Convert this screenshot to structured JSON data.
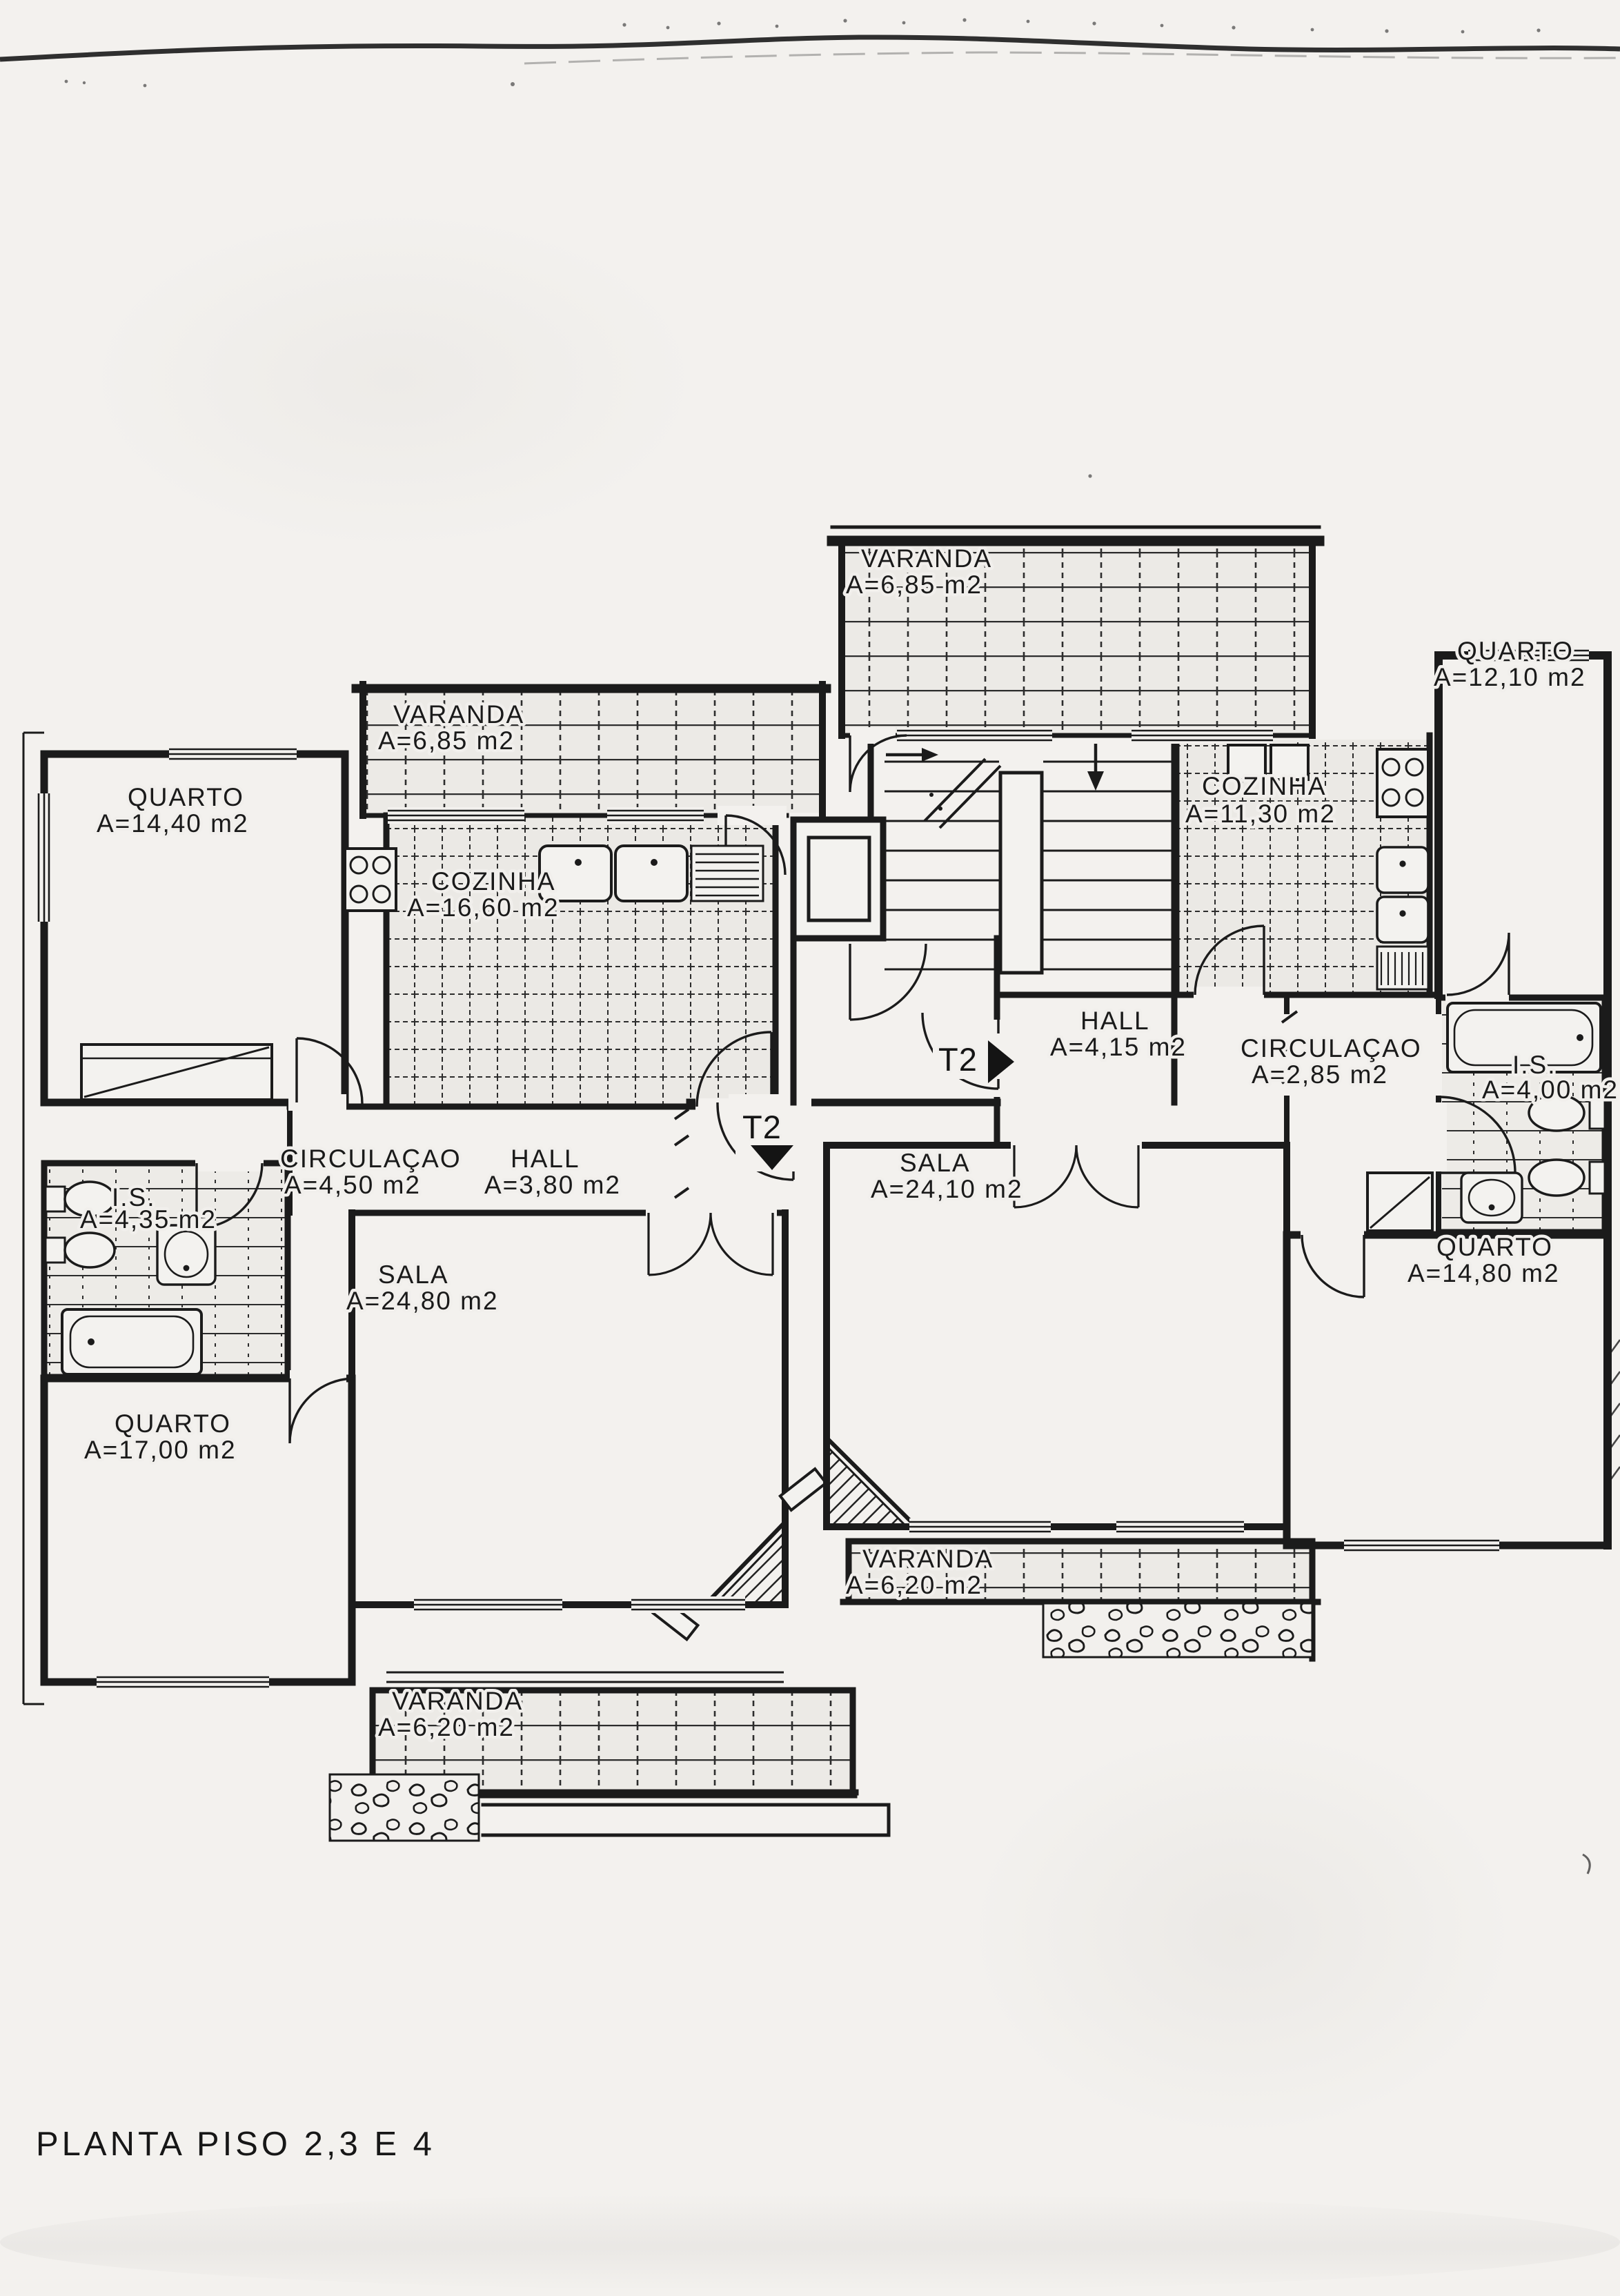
{
  "title": "PLANTA PISO 2,3 E 4",
  "colors": {
    "ink": "#1b1b1b",
    "paper": "#f3f1ee",
    "tile_fill": "#eceae6"
  },
  "units": {
    "left": {
      "marker": "T2",
      "rooms": {
        "varanda_top": {
          "name": "VARANDA",
          "area": "A=6,85  m2"
        },
        "quarto_1": {
          "name": "QUARTO",
          "area": "A=14,40  m2"
        },
        "cozinha": {
          "name": "COZINHA",
          "area": "A=16,60  m2"
        },
        "circulacao": {
          "name": "CIRCULAÇAO",
          "area": "A=4,50  m2"
        },
        "hall": {
          "name": "HALL",
          "area": "A=3,80  m2"
        },
        "is": {
          "name": "I.S.",
          "area": "A=4,35 m2"
        },
        "sala": {
          "name": "SALA",
          "area": "A=24,80  m2"
        },
        "quarto_2": {
          "name": "QUARTO",
          "area": "A=17,00  m2"
        },
        "varanda_bottom": {
          "name": "VARANDA",
          "area": "A=6,20  m2"
        }
      }
    },
    "right": {
      "marker": "T2",
      "rooms": {
        "varanda_top": {
          "name": "VARANDA",
          "area": "A=6,85  m2"
        },
        "cozinha": {
          "name": "COZINHA",
          "area": "A=11,30  m2"
        },
        "quarto_1": {
          "name": "QUARTO",
          "area": "A=12,10  m2"
        },
        "hall": {
          "name": "HALL",
          "area": "A=4,15  m2"
        },
        "circulacao": {
          "name": "CIRCULAÇAO",
          "area": "A=2,85  m2"
        },
        "is": {
          "name": "I.S.",
          "area": "A=4,00  m2"
        },
        "sala": {
          "name": "SALA",
          "area": "A=24,10  m2"
        },
        "quarto_2": {
          "name": "QUARTO",
          "area": "A=14,80  m2"
        },
        "varanda_bottom": {
          "name": "VARANDA",
          "area": "A=6,20  m2"
        }
      }
    }
  }
}
